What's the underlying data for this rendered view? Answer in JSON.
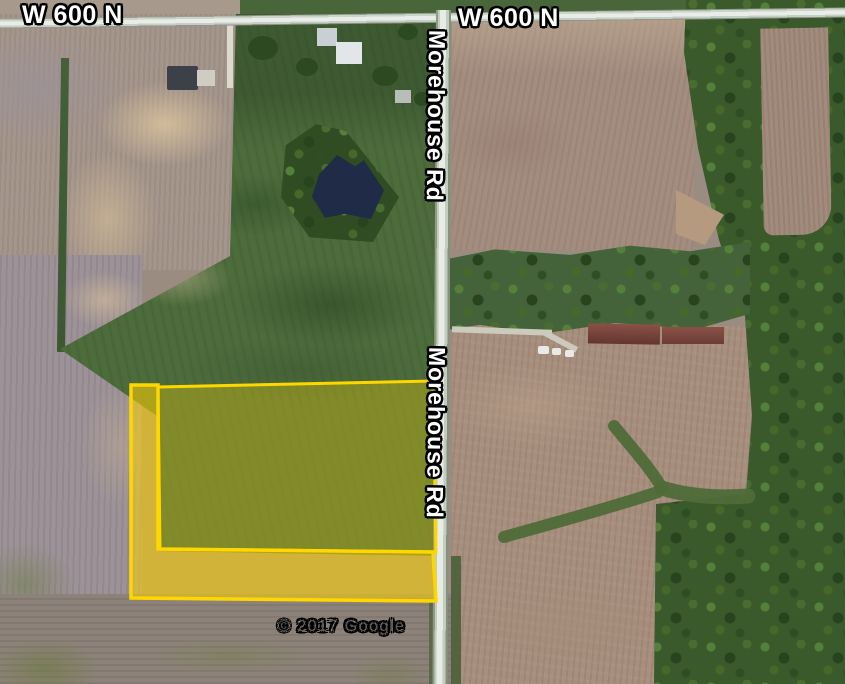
{
  "map": {
    "attribution": "© 2017 Google",
    "roads": {
      "w600n_label_left": "W 600 N",
      "w600n_label_right": "W 600 N",
      "morehouse_label_upper": "Morehouse Rd",
      "morehouse_label_lower": "Morehouse Rd"
    },
    "parcel": {
      "outline_color": "#FFD700",
      "upper_field_points": "158,387 433,381 436,552 160,549",
      "l_strip_points": "131,385 158,385 158,549 433,552 436,601 131,598"
    },
    "colors": {
      "parcel_outline": "#FFD700",
      "label_text": "#FFFFFF",
      "label_outline": "#000000"
    }
  }
}
